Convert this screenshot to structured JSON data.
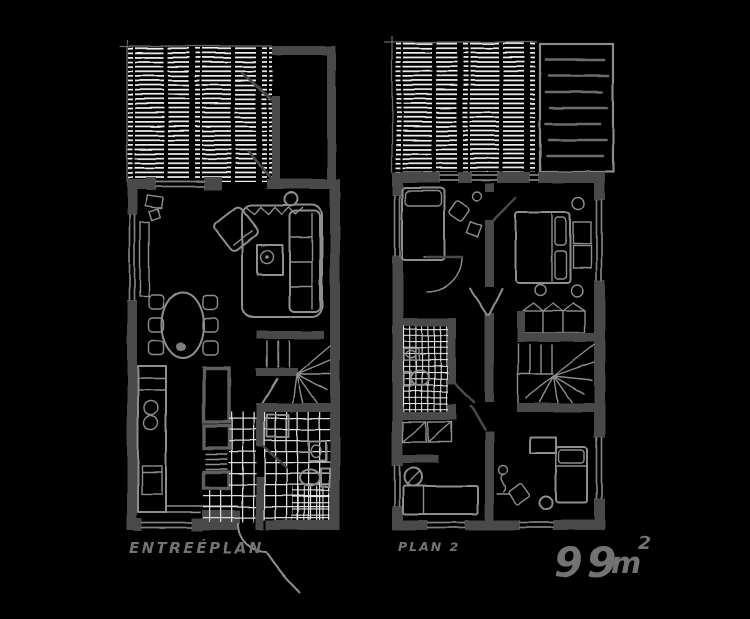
{
  "labels": {
    "left_plan": "ENTREÉPLAN",
    "right_plan": "PLAN 2",
    "area_value": "99",
    "area_unit": "m",
    "area_sup": "2"
  },
  "colors": {
    "background": "#000000",
    "wall": "#4a4a4a",
    "furniture": "#8e8e8e",
    "hatch": "#f0f0f0",
    "tile": "#dcdcdc",
    "tile_fine": "#e8e8e8",
    "window": "#7e7e7e",
    "roof_line": "#6c6c6c",
    "roof_border": "#8a8a8a",
    "label_text": "#737373"
  }
}
